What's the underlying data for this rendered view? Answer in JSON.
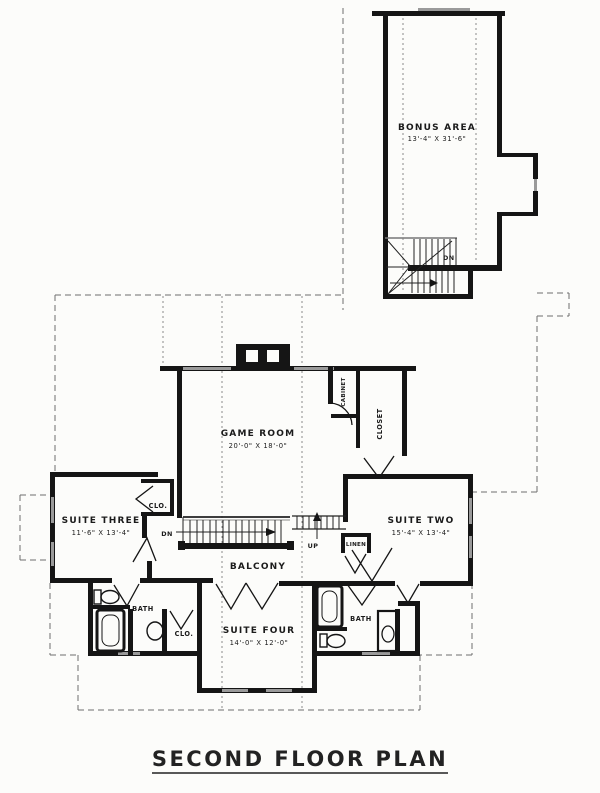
{
  "page": {
    "title": "SECOND FLOOR PLAN"
  },
  "rooms": {
    "bonus_area": {
      "label": "BONUS AREA",
      "dims": "13'-4\" X 31'-6\""
    },
    "game_room": {
      "label": "GAME ROOM",
      "dims": "20'-0\" X 18'-0\""
    },
    "suite_two": {
      "label": "SUITE TWO",
      "dims": "15'-4\" X 13'-4\""
    },
    "suite_three": {
      "label": "SUITE THREE",
      "dims": "11'-6\" X 13'-4\""
    },
    "suite_four": {
      "label": "SUITE FOUR",
      "dims": "14'-0\" X 12'-0\""
    },
    "balcony": {
      "label": "BALCONY"
    }
  },
  "closets": {
    "closet": "CLOSET",
    "cabinet": "CABINET",
    "linen": "LINEN",
    "clo_upper": "CLO.",
    "clo_lower": "CLO."
  },
  "baths": {
    "left": "BATH",
    "right": "BATH"
  },
  "stairs": {
    "dn_bonus": "DN",
    "dn_main": "DN",
    "up_main": "UP"
  },
  "colors": {
    "wall": "#151515",
    "window_gray": "#9a9a9a",
    "dash_gray": "#6e6e6e",
    "paper": "#fcfcfa"
  }
}
